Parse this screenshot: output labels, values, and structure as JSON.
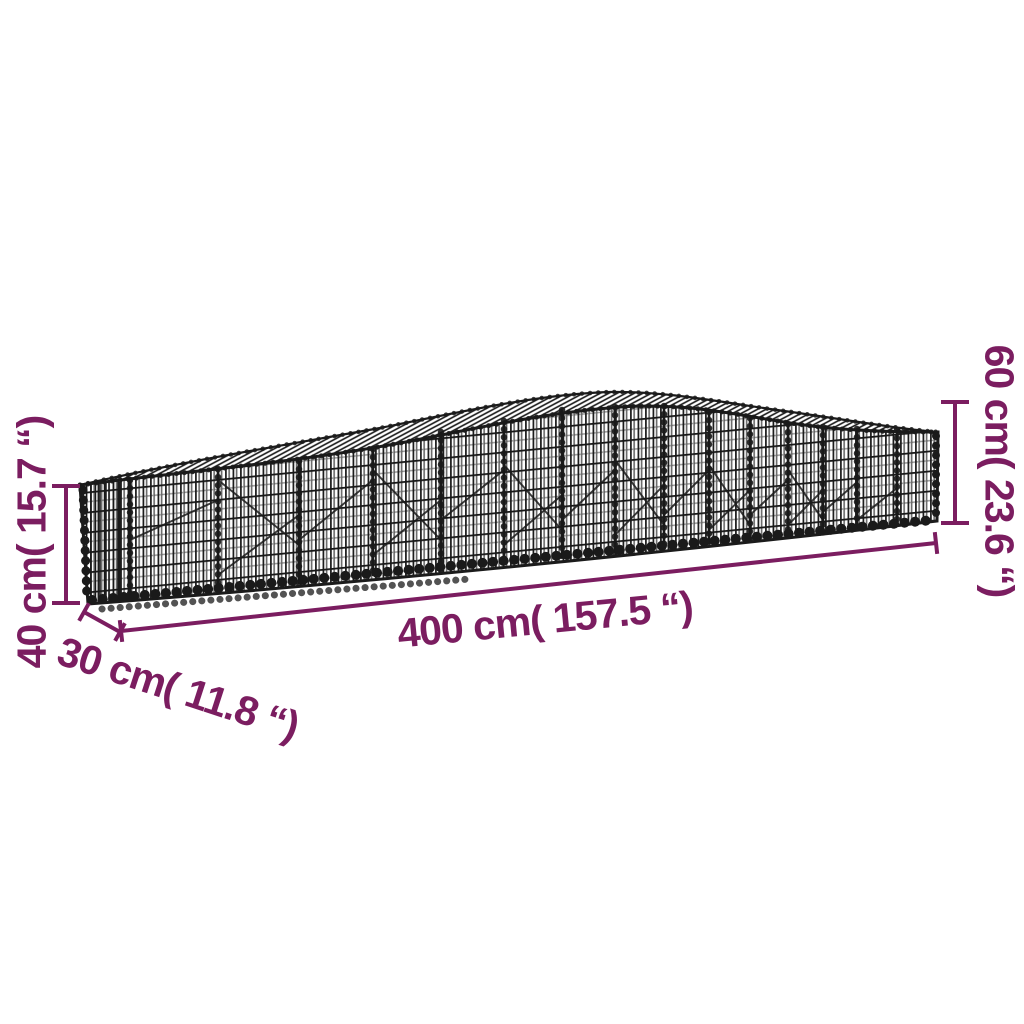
{
  "illustration": {
    "subject": "arched gabion basket wire mesh — product dimension diagram"
  },
  "dimension_labels": {
    "length": "400 cm( 157.5 “)",
    "depth": "30 cm( 11.8 “)",
    "height_left": "40 cm( 15.7 “)",
    "height_right": "60 cm( 23.6 “)"
  },
  "colors": {
    "dimension_annotation": "#7B1D60",
    "wire": "#1a1a1a",
    "background": "#ffffff"
  }
}
